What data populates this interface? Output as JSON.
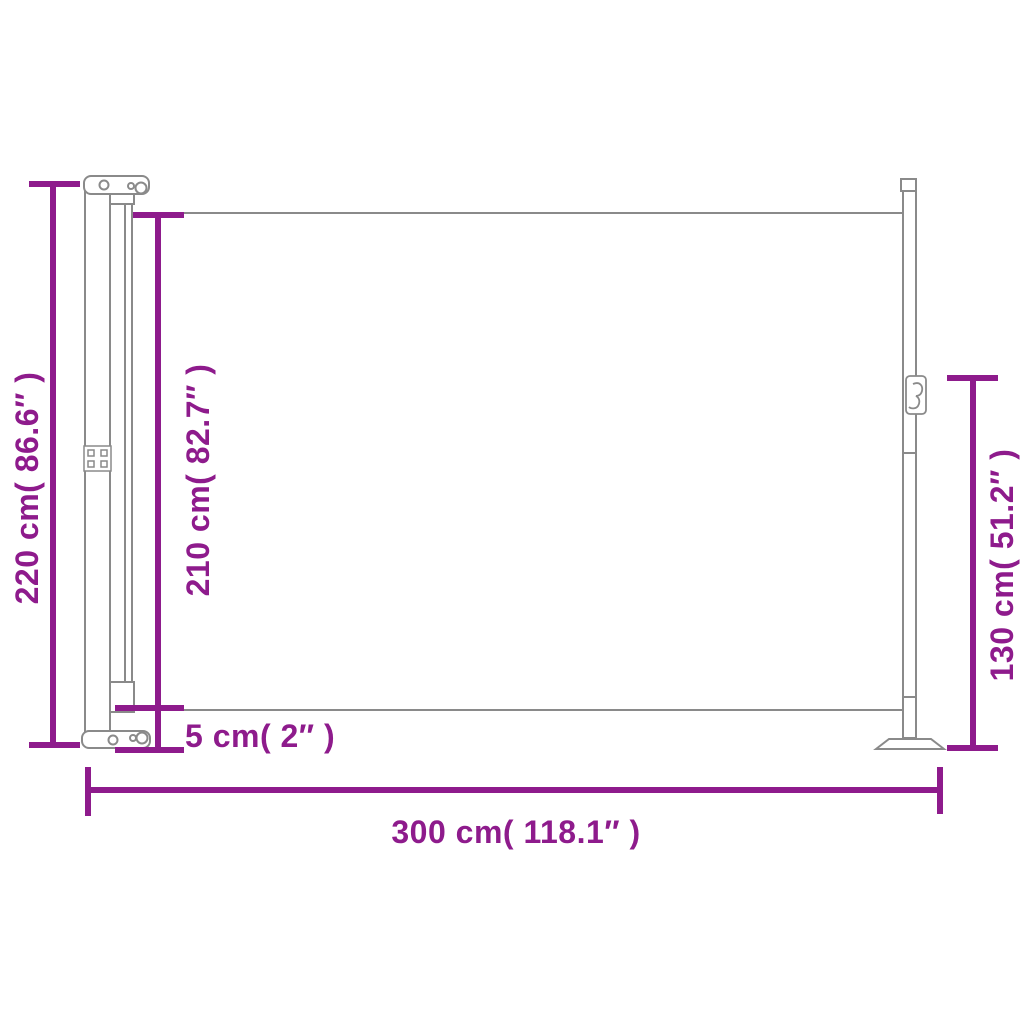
{
  "colors": {
    "dimension": "#8E1B8C",
    "outline": "#8A8A8A",
    "background": "#FFFFFF"
  },
  "diagram": {
    "subject": "retractable side awning side view",
    "labels": {
      "total_height": "220 cm( 86.6″ )",
      "fabric_height": "210 cm( 82.7″ )",
      "bottom_clearance": "5 cm( 2″ )",
      "end_post_height": "130 cm( 51.2″ )",
      "total_width": "300 cm( 118.1″ )"
    }
  }
}
